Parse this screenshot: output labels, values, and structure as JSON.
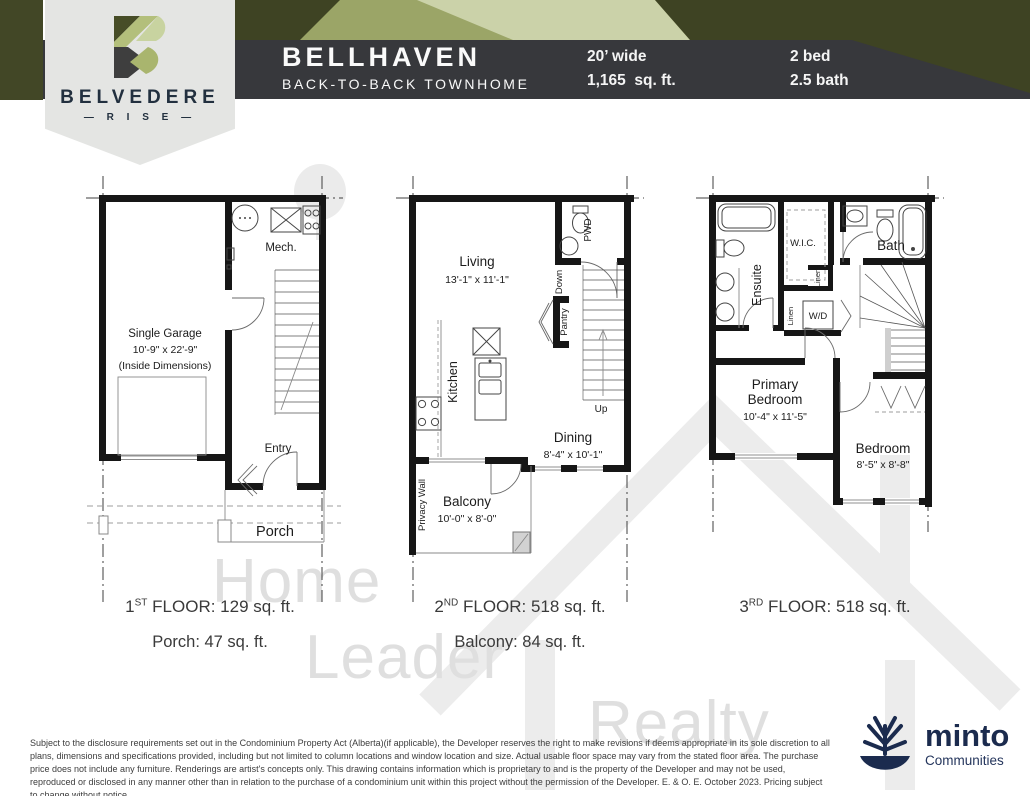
{
  "badge": {
    "brand": "BELVEDERE",
    "sub": "— R I S E —"
  },
  "header": {
    "title": "BELLHAVEN",
    "subtitle": "BACK-TO-BACK TOWNHOME",
    "specs": {
      "width": "20’ wide",
      "area": "1,165  sq. ft.",
      "bed": "2 bed",
      "bath": "2.5 bath"
    }
  },
  "plan1": {
    "rooms": {
      "mech": "Mech.",
      "garage1": "Single Garage",
      "garage2": "10'-9\" x 22'-9\"",
      "garage3": "(Inside Dimensions)",
      "entry": "Entry",
      "porch": "Porch"
    },
    "caption": {
      "num": "1",
      "ord": "ST",
      "rest": "FLOOR: 129  sq. ft."
    },
    "caption2": "Porch: 47 sq. ft."
  },
  "plan2": {
    "rooms": {
      "living": "Living",
      "living_dims": "13'-1\" x 11'-1\"",
      "pwd": "PWD",
      "down": "Down",
      "pantry": "Pantry",
      "up": "Up",
      "kitchen": "Kitchen",
      "dining": "Dining",
      "dining_dims": "8'-4\" x 10'-1\"",
      "privacy": "Privacy Wall",
      "balcony": "Balcony",
      "balcony_dims": "10'-0\" x 8'-0\""
    },
    "caption": {
      "num": "2",
      "ord": "ND",
      "rest": "FLOOR: 518  sq. ft."
    },
    "caption2": "Balcony: 84 sq. ft."
  },
  "plan3": {
    "rooms": {
      "ensuite": "Ensuite",
      "wic": "W.I.C.",
      "bath": "Bath",
      "linen1": "Linen",
      "linen2": "Linen",
      "wd": "W/D",
      "primary1": "Primary",
      "primary2": "Bedroom",
      "primary_dims": "10'-4\" x 11'-5\"",
      "bedroom": "Bedroom",
      "bedroom_dims": "8'-5\" x 8'-8\""
    },
    "caption": {
      "num": "3",
      "ord": "RD",
      "rest": "FLOOR: 518  sq. ft."
    }
  },
  "watermark": {
    "l1": "Home",
    "l2": "Leader",
    "l3": "Realty"
  },
  "disclaimer": "Subject to the disclosure requirements set out in the Condominium Property Act (Alberta)(if applicable), the Developer reserves the right to make revisions if deems appropriate in its sole discretion to all plans, dimensions and specifications provided, including but not limited to column locations and window location and size. Actual usable floor space may vary from the stated floor area. The purchase price does not include any furniture. Renderings are artist's concepts only. This drawing contains information which is proprietary to and is the property of the Developer and may not be used, reproduced or disclosed in any manner other than in relation to the purchase of a condominium unit within this project without the permission of the Developer. E. & O. E. October 2023. Pricing subject to change without notice.",
  "minto": {
    "name": "minto",
    "sub": "Communities"
  },
  "colors": {
    "band": "#37383c",
    "olive_dark": "#3e4323",
    "olive_block": "#424726",
    "green_mid": "#9ba567",
    "sage": "#cbd2a9",
    "badge_bg": "#e4e5e3",
    "navy": "#22303f",
    "minto_navy": "#1b2b4e",
    "watermark": "#dfdfdf",
    "walls": "#161616"
  }
}
